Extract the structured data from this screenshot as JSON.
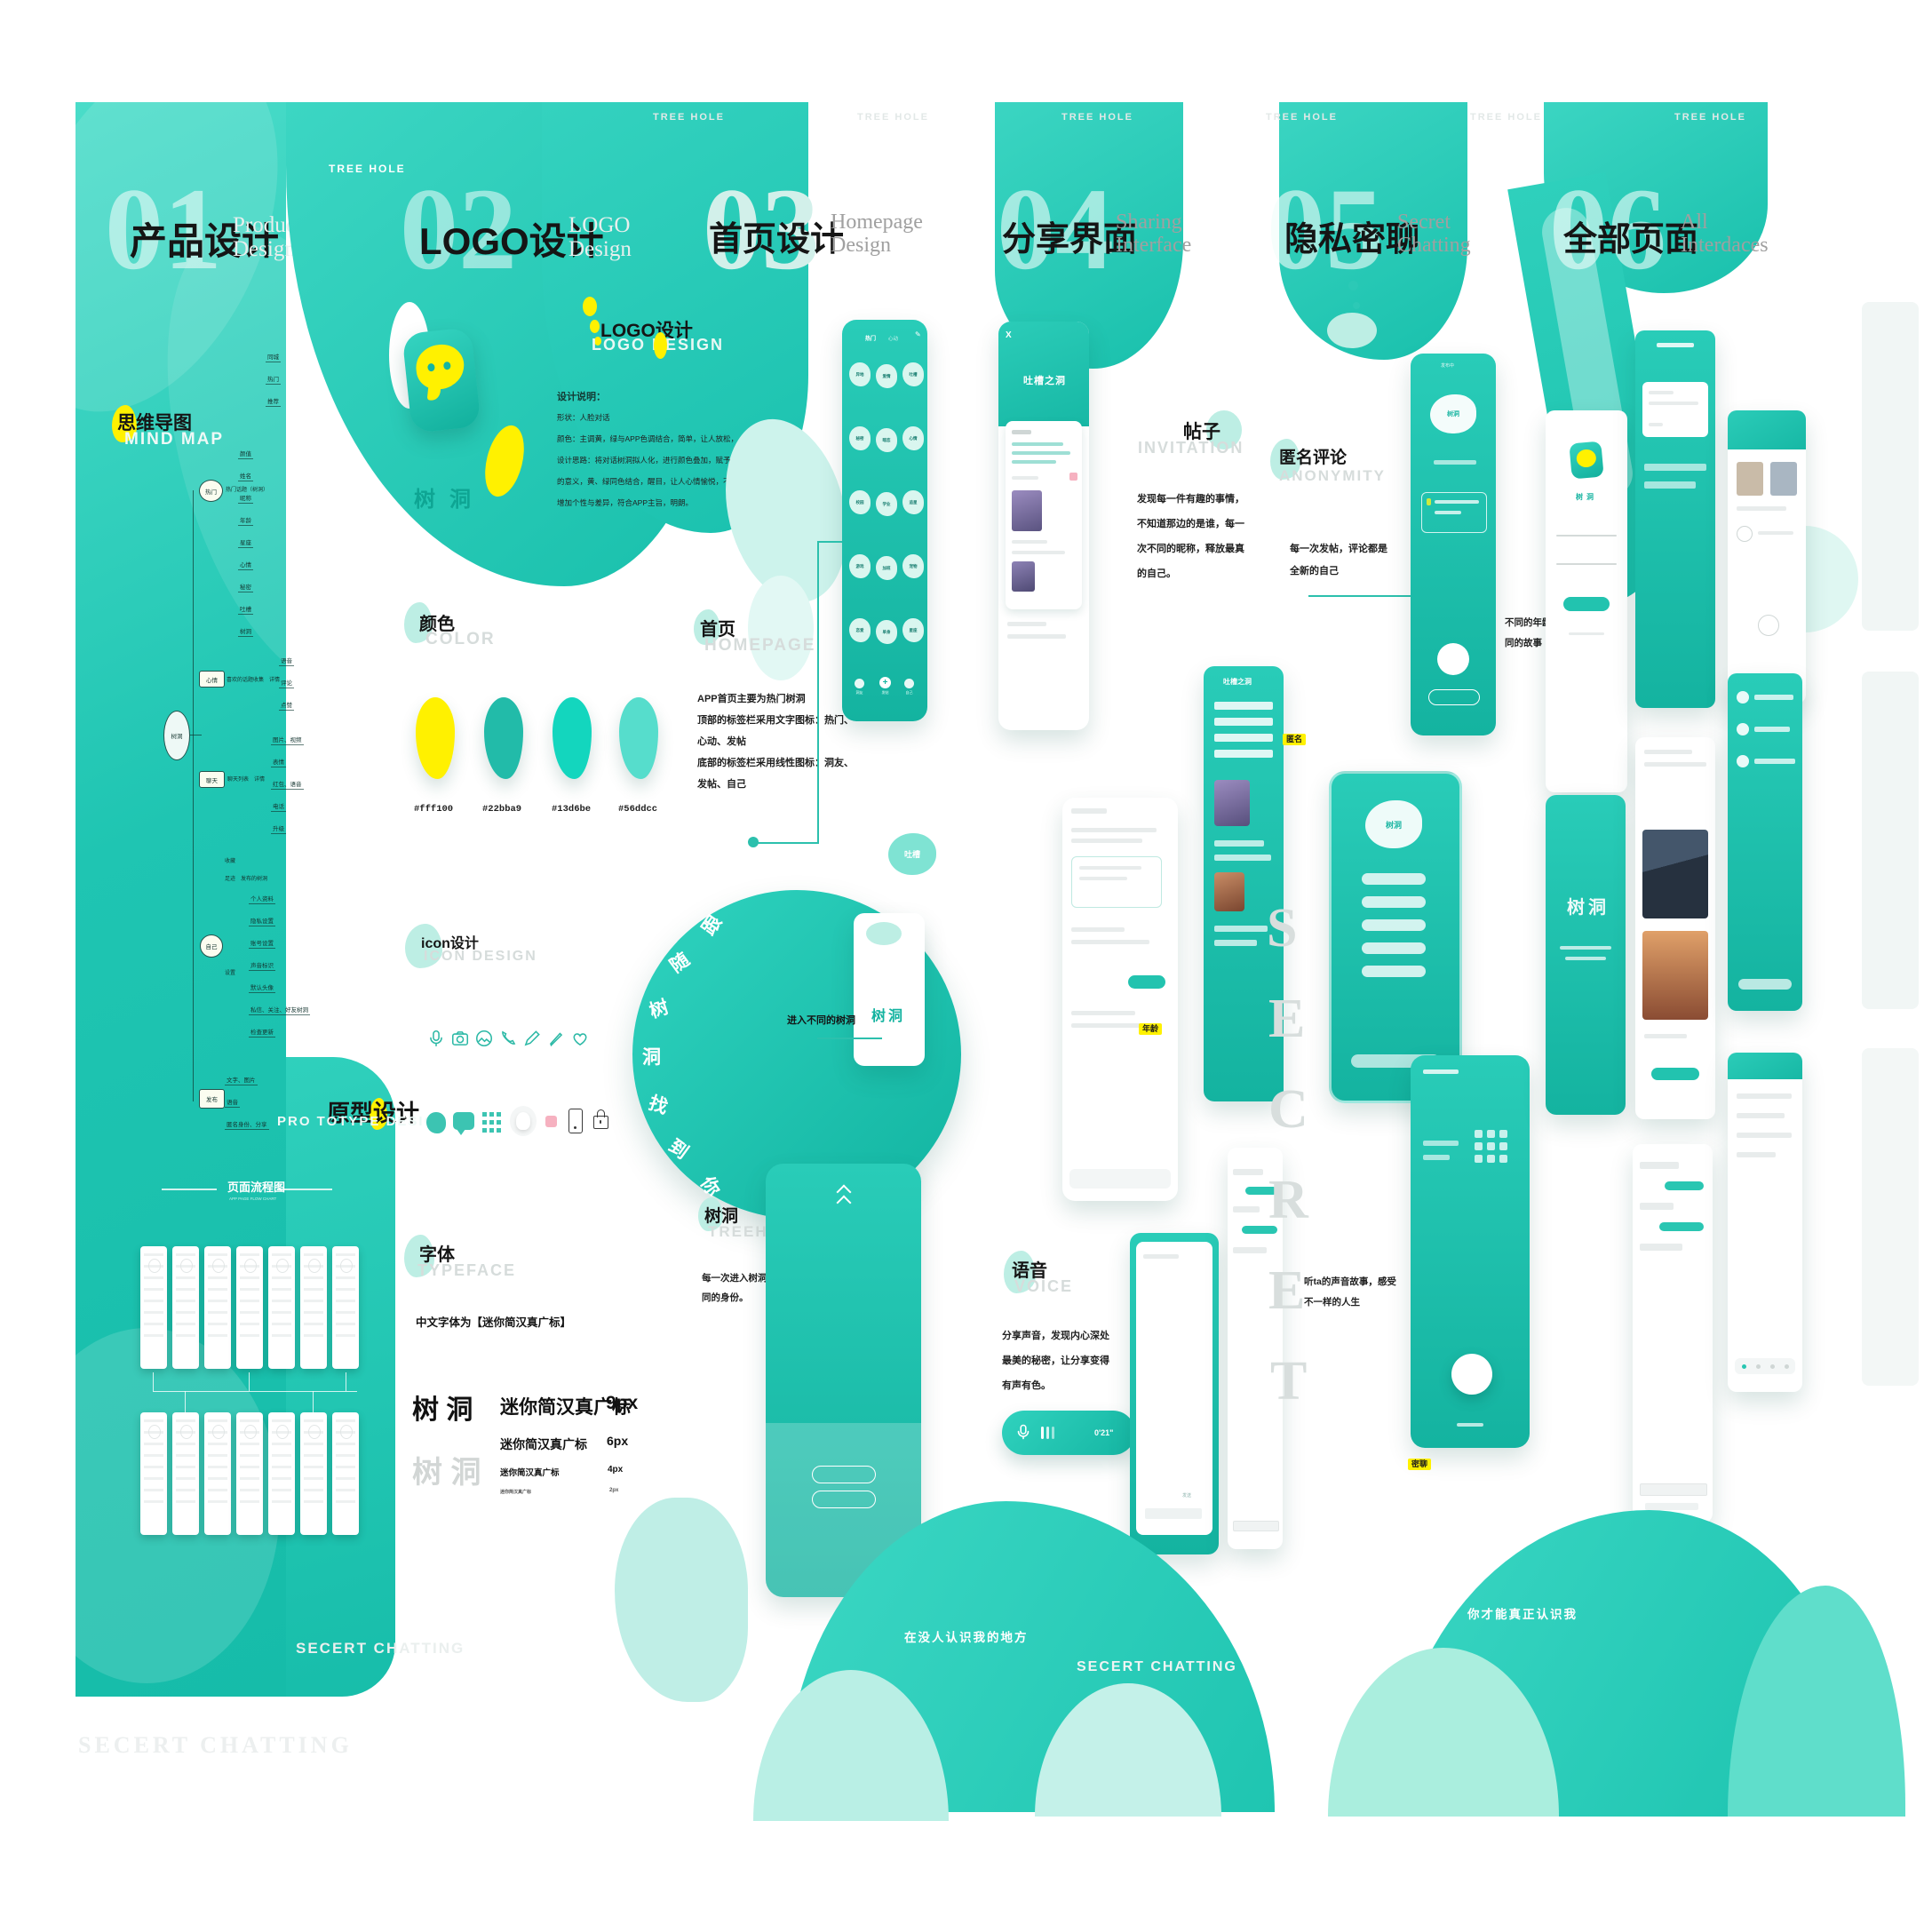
{
  "brand": "TREE HOLE",
  "marks": {
    "secret_chatting": "SECERT CHATTING",
    "secret_letters": [
      "S",
      "E",
      "C",
      "R",
      "E",
      "T"
    ]
  },
  "bottom": {
    "left_blob": "在没人认识我的地方",
    "right_blob": "你才能真正认识我"
  },
  "p1": {
    "num": "01",
    "title": "产品设计",
    "en1": "Product",
    "en2": "Design",
    "mindmap": {
      "zh": "思维导图",
      "en": "MIND MAP",
      "root": "树洞",
      "b1": {
        "label": "热门",
        "note": "热门话题（树洞）",
        "leavesA": [
          "同城",
          "热门",
          "推荐"
        ],
        "leavesB": [
          "颜值",
          "姓名",
          "昵称",
          "年龄",
          "星座",
          "心情",
          "秘密",
          "吐槽",
          "树洞"
        ]
      },
      "b2": {
        "label": "心情",
        "note": "喜欢的话题收集　详情",
        "leaves": [
          "语音",
          "评论",
          "点赞"
        ]
      },
      "b3": {
        "label": "聊天",
        "note": "聊天列表　详情",
        "leaves": [
          "图片、视频",
          "表情",
          "红包、语音",
          "电话",
          "升级"
        ]
      },
      "b4": {
        "label": "自己",
        "g1a": "收藏",
        "g1b": "足迹　发布的树洞",
        "g2": "设置",
        "leaves": [
          "个人资料",
          "隐私设置",
          "账号设置",
          "声音标识",
          "默认头像",
          "私信、关注、好友树洞",
          "检查更新"
        ]
      },
      "b5": {
        "label": "发布",
        "leaves": [
          "文字、图片",
          "语音",
          "匿名身份、分享"
        ]
      }
    },
    "proto": {
      "zh": "原型设计",
      "en": "PRO TOTYPE DESIGN"
    },
    "flow": {
      "zh": "页面流程图",
      "en": "APP PAGE FLOW CHART"
    }
  },
  "p2": {
    "num": "02",
    "title": "LOGO设计",
    "en1": "LOGO",
    "en2": "Design",
    "header_zh": "LOGO设计",
    "header_en": "LOGO DESIGN",
    "logo_ch1": "树",
    "logo_ch2": "洞",
    "desc_title": "设计说明：",
    "desc": [
      "形状：人脸对话",
      "颜色：主调黄，绿与APP色调结合，简单，让人放松，",
      "设计思路：将对话树洞拟人化，进行颜色叠加，赋予隐私",
      "的意义，黄、绿同色结合，醒目，让人心情愉悦，不呆板，",
      "增加个性与差异，符合APP主旨，明朗。"
    ],
    "color": {
      "zh": "颜色",
      "en": "COLOR",
      "hex": [
        "#fff100",
        "#22bba9",
        "#13d6be",
        "#56ddcc"
      ]
    },
    "icons": {
      "zh": "icon设计",
      "en": "ICON DESIGN"
    },
    "circle": [
      "跟",
      "随",
      "树",
      "洞",
      "找",
      "到",
      "你"
    ],
    "type": {
      "zh": "字体",
      "en": "TYPEFACE",
      "note": "中文字体为【迷你简汉真广标】",
      "big": "树  洞",
      "gray": "树  洞",
      "rows": [
        {
          "t": "迷你简汉真广标",
          "s": "9px"
        },
        {
          "t": "迷你简汉真广标",
          "s": "6px"
        },
        {
          "t": "迷你简汉真广标",
          "s": "4px"
        },
        {
          "t": "迷你简汉真广标",
          "s": "2px"
        }
      ]
    }
  },
  "p3": {
    "num": "03",
    "title": "首页设计",
    "en1": "Homepage",
    "en2": "Design",
    "phone": {
      "tab1": "热门",
      "tab2": "心动",
      "pencil": "✎",
      "bubbles": [
        "异地",
        "爱情",
        "吐槽",
        "秘密",
        "暗恋",
        "心情",
        "校园",
        "学业",
        "追星",
        "游戏",
        "加班",
        "宠物",
        "恋爱",
        "单身",
        "星座"
      ],
      "nav": [
        "洞友",
        "发帖",
        "自己"
      ]
    },
    "home": {
      "zh": "首页",
      "en": "HOMEPAGE",
      "lines": [
        "APP首页主要为热门树洞",
        "顶部的标签栏采用文字图标：热门、",
        "心动、发帖",
        "底部的标签栏采用线性图标：洞友、",
        "发帖、自己"
      ]
    },
    "enter": "进入不同的树洞",
    "card": {
      "bubble": "吐槽",
      "label": "树洞"
    },
    "tree": {
      "zh": "树洞",
      "en": "TREEHOLE",
      "lines": [
        "每一次进入树洞，留下不",
        "同的身份。"
      ]
    },
    "tag": "树洞"
  },
  "p4": {
    "num": "04",
    "title": "分享界面",
    "en1": "Sharing",
    "en2": "Interface",
    "post": {
      "zh": "帖子",
      "en": "INVITATION",
      "lines": [
        "发现每一件有趣的事情，",
        "不知道那边的是谁，每一",
        "次不同的昵称，释放最真",
        "的自己。"
      ]
    },
    "voice": {
      "zh": "语音",
      "en": "VOICE",
      "lines": [
        "分享声音，发现内心深处",
        "最美的秘密，让分享变得",
        "有声有色。"
      ],
      "time": "0'21\""
    },
    "phoneA_title": "吐槽之洞",
    "phoneA_close": "X",
    "phoneB_title": "吐槽之洞",
    "tag": "年龄"
  },
  "p5": {
    "num": "05",
    "title": "隐私密聊",
    "en1": "Secret",
    "en2": "Chatting",
    "anon": {
      "zh": "匿名评论",
      "en": "ANONYMITY",
      "lines": [
        "每一次发帖，评论都是",
        "全新的自己"
      ]
    },
    "age_note": [
      "不同的年龄段，倾听不",
      "同的故事"
    ],
    "voice_note": [
      "听ta的声音故事，感受",
      "不一样的人生"
    ],
    "tag_anon": "匿名",
    "tag_chat": "密聊",
    "phone_label": "树洞"
  },
  "p6": {
    "num": "06",
    "title": "全部页面",
    "en1": "All",
    "en2": "Interdaces",
    "s4_label": "树洞"
  }
}
